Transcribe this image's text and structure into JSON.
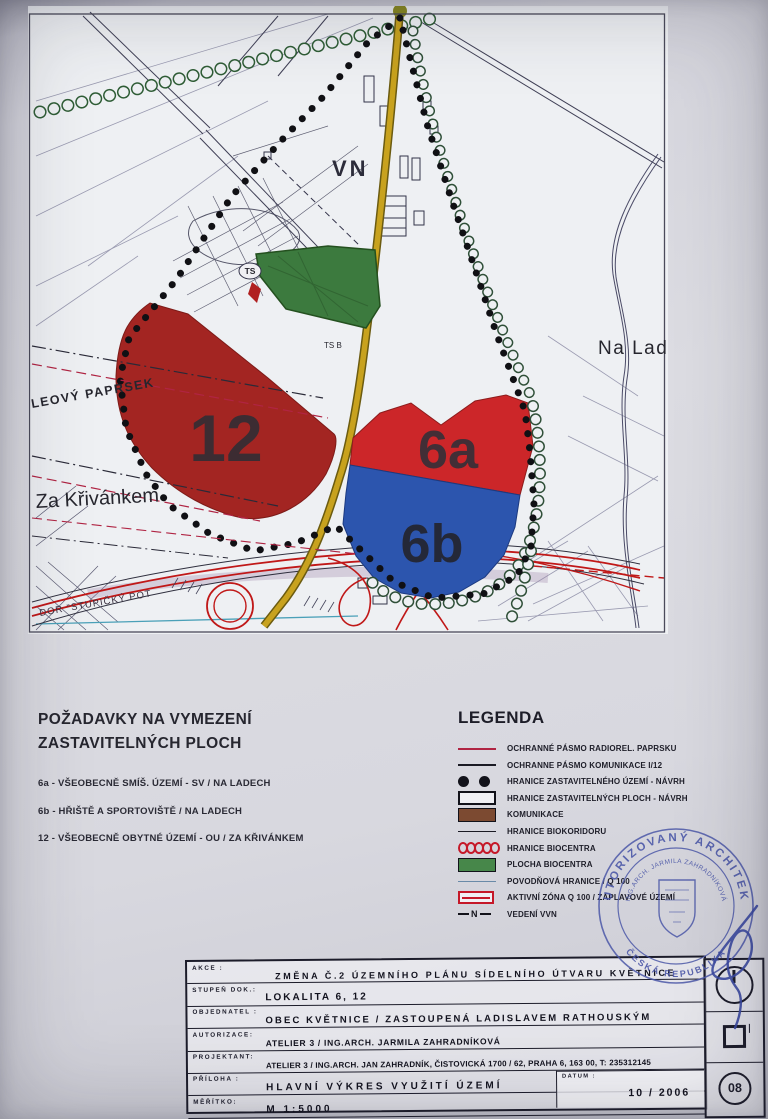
{
  "colors": {
    "area12_red": "#a32522",
    "area6a_red": "#cc2629",
    "area6b_blue": "#2c55ae",
    "biocentrum_green": "#3c7a3e",
    "road_yellow": "#c8a21e",
    "corridor_red": "#c01818",
    "stamp_blue": "#4c58a8"
  },
  "map": {
    "labels": {
      "vn": "VN",
      "na_lad": "Na Lad",
      "za_krivankem": "Za Křivánkem",
      "leovy_paprsek": "LEOVÝ PAPRSEK",
      "ts": "TS",
      "ts_b": "TS B",
      "stupicka": "DOR \"STUPIČKÝ POT",
      "area_12": "12",
      "area_6a": "6a",
      "area_6b": "6b"
    }
  },
  "requirements": {
    "title_line1": "POŽADAVKY NA VYMEZENÍ",
    "title_line2": "ZASTAVITELNÝCH PLOCH",
    "items": [
      "6a - VŠEOBECNĚ SMÍŠ. ÚZEMÍ - SV / NA LADECH",
      "6b - HŘIŠTĚ A SPORTOVIŠTĚ / NA LADECH",
      "12 - VŠEOBECNĚ OBYTNÉ ÚZEMÍ - OU / ZA KŘIVÁNKEM"
    ]
  },
  "legend": {
    "title": "LEGENDA",
    "vvn_symbol": "N",
    "items": [
      {
        "symbol": "red-line",
        "label": "OCHRANNÉ PÁSMO RADIOREL. PAPRSKU"
      },
      {
        "symbol": "black-line",
        "label": "OCHRANNE PÁSMO KOMUNIKACE I/12"
      },
      {
        "symbol": "black-dots",
        "label": "HRANICE ZASTAVITELNÉHO ÚZEMÍ - NÁVRH"
      },
      {
        "symbol": "white-rect",
        "label": "HRANICE ZASTAVITELNÝCH PLOCH - NÁVRH"
      },
      {
        "symbol": "brown-rect",
        "label": "KOMUNIKACE"
      },
      {
        "symbol": "thin-line",
        "label": "HRANICE BIOKORIDORU"
      },
      {
        "symbol": "red-circles",
        "label": "HRANICE BIOCENTRA"
      },
      {
        "symbol": "green-rect",
        "label": "PLOCHA BIOCENTRA"
      },
      {
        "symbol": "blue-line",
        "label": "POVODŇOVÁ HRANICE / Q 100"
      },
      {
        "symbol": "red-outline-rect",
        "label": "AKTIVNÍ ZÓNA Q 100 / ZÁPLAVOVÉ ÚZEMÍ"
      },
      {
        "symbol": "vvn",
        "label": "VEDENÍ VVN"
      }
    ]
  },
  "stamp": {
    "ring_text": "AUTORIZOVANÝ ARCHITEKT",
    "ring_bottom_text": "ČESKÁ REPUBLIKA",
    "inner_text": "ING.ARCH. JARMILA ZAHRADNÍKOVÁ"
  },
  "titleblock": {
    "rows": [
      {
        "label": "AKCE :",
        "value": "ZMĚNA Č.2 ÚZEMNÍHO PLÁNU SÍDELNÍHO ÚTVARU KVĚTNICE"
      },
      {
        "label": "STUPEŇ DOK.:",
        "value": "LOKALITA 6, 12"
      },
      {
        "label": "OBJEDNATEL :",
        "value": "OBEC KVĚTNICE / ZASTOUPENÁ LADISLAVEM RATHOUSKÝM"
      },
      {
        "label": "AUTORIZACE:",
        "value": "ATELIER 3 / ING.ARCH. JARMILA ZAHRADNÍKOVÁ"
      },
      {
        "label": "PROJEKTANT:",
        "value": "ATELIER 3 / ING.ARCH. JAN ZAHRADNÍK, ČISTOVICKÁ 1700 / 62, PRAHA 6, 163 00, T: 235312145"
      },
      {
        "label": "PŘÍLOHA :",
        "value": "HLAVNÍ VÝKRES VYUŽITÍ ÚZEMÍ"
      },
      {
        "label": "MĚŘÍTKO:",
        "value": "M 1:5000"
      }
    ],
    "datum_label": "DATUM :",
    "datum_value": "10 / 2006",
    "sheet_number": "08"
  }
}
